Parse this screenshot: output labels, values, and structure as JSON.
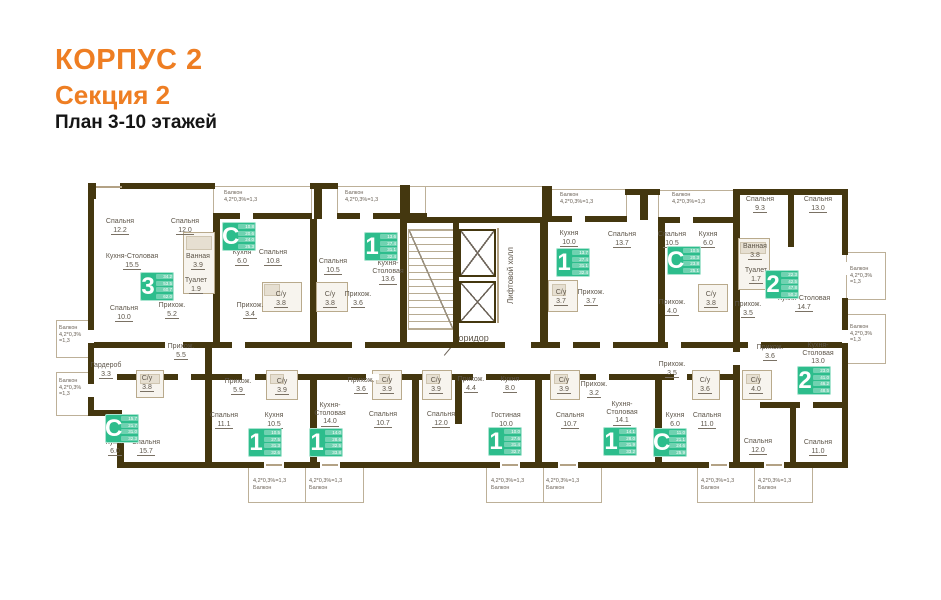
{
  "title": {
    "line1": "КОРПУС 2",
    "line2": "Секция 2",
    "line3": "План 3-10 этажей"
  },
  "zones": {
    "corridor": "Коридор",
    "lift_hall": "Лифтовой холл",
    "open_balcony": "Открытый балкон"
  },
  "colors": {
    "accent_orange": "#ee7e23",
    "wall_dark": "#44370f",
    "wall_thin": "#b3a285",
    "badge_green": "#2dbd8c",
    "label_gray": "#5e564a"
  },
  "plan": {
    "rooms": [
      {
        "n": "Спальня",
        "a": "12.2",
        "x": 120,
        "y": 226
      },
      {
        "n": "Спальня",
        "a": "12.0",
        "x": 185,
        "y": 226
      },
      {
        "n": "Кухня-Столовая",
        "a": "15.5",
        "x": 132,
        "y": 261
      },
      {
        "n": "Ванная",
        "a": "3.9",
        "x": 198,
        "y": 261
      },
      {
        "n": "Туалет",
        "a": "1.9",
        "x": 196,
        "y": 285
      },
      {
        "n": "Спальня",
        "a": "10.0",
        "x": 124,
        "y": 313
      },
      {
        "n": "Прихож.",
        "a": "5.2",
        "x": 172,
        "y": 310
      },
      {
        "n": "Кухня",
        "a": "6.0",
        "x": 242,
        "y": 257
      },
      {
        "n": "Спальня",
        "a": "10.8",
        "x": 273,
        "y": 257
      },
      {
        "n": "С/у",
        "a": "3.8",
        "x": 281,
        "y": 299
      },
      {
        "n": "Прихож.",
        "a": "3.4",
        "x": 250,
        "y": 310
      },
      {
        "n": "Спальня",
        "a": "10.5",
        "x": 333,
        "y": 266
      },
      {
        "n": "С/у",
        "a": "3.8",
        "x": 330,
        "y": 299
      },
      {
        "n": "Прихож.",
        "a": "3.6",
        "x": 358,
        "y": 299
      },
      {
        "n": "Кухня-\nСтоловая",
        "a": "13.6",
        "x": 388,
        "y": 271
      },
      {
        "n": "Кухня",
        "a": "10.0",
        "x": 569,
        "y": 238
      },
      {
        "n": "Спальня",
        "a": "13.7",
        "x": 622,
        "y": 239
      },
      {
        "n": "С/у",
        "a": "3.7",
        "x": 561,
        "y": 297
      },
      {
        "n": "Прихож.",
        "a": "3.7",
        "x": 591,
        "y": 297
      },
      {
        "n": "Спальня",
        "a": "10.5",
        "x": 672,
        "y": 239
      },
      {
        "n": "Кухня",
        "a": "6.0",
        "x": 708,
        "y": 239
      },
      {
        "n": "Прихож.",
        "a": "4.0",
        "x": 672,
        "y": 307
      },
      {
        "n": "С/у",
        "a": "3.8",
        "x": 711,
        "y": 299
      },
      {
        "n": "Спальня",
        "a": "9.3",
        "x": 760,
        "y": 204
      },
      {
        "n": "Спальня",
        "a": "13.0",
        "x": 818,
        "y": 204
      },
      {
        "n": "Ванная",
        "a": "3.8",
        "x": 755,
        "y": 251
      },
      {
        "n": "Туалет",
        "a": "1.7",
        "x": 756,
        "y": 275
      },
      {
        "n": "Кухня-Столовая",
        "a": "14.7",
        "x": 804,
        "y": 303
      },
      {
        "n": "Прихож.",
        "a": "3.5",
        "x": 748,
        "y": 309
      },
      {
        "n": "Гардероб",
        "a": "3.3",
        "x": 106,
        "y": 370
      },
      {
        "n": "Прихож.",
        "a": "5.5",
        "x": 181,
        "y": 351
      },
      {
        "n": "С/у",
        "a": "3.8",
        "x": 147,
        "y": 383
      },
      {
        "n": "Кухня",
        "a": "6.0",
        "x": 115,
        "y": 447
      },
      {
        "n": "Спальня",
        "a": "15.7",
        "x": 146,
        "y": 447
      },
      {
        "n": "Спальня",
        "a": "11.1",
        "x": 224,
        "y": 420
      },
      {
        "n": "Прихож.",
        "a": "5.9",
        "x": 238,
        "y": 386
      },
      {
        "n": "С/у",
        "a": "3.9",
        "x": 282,
        "y": 386
      },
      {
        "n": "Кухня",
        "a": "10.5",
        "x": 274,
        "y": 420
      },
      {
        "n": "Прихож.",
        "a": "3.6",
        "x": 361,
        "y": 385
      },
      {
        "n": "С/у",
        "a": "3.9",
        "x": 387,
        "y": 385
      },
      {
        "n": "Кухня-\nСтоловая",
        "a": "14.0",
        "x": 330,
        "y": 413
      },
      {
        "n": "Спальня",
        "a": "10.7",
        "x": 383,
        "y": 419
      },
      {
        "n": "С/у",
        "a": "3.9",
        "x": 436,
        "y": 385
      },
      {
        "n": "Прихож.",
        "a": "4.4",
        "x": 471,
        "y": 384
      },
      {
        "n": "Спальня",
        "a": "12.0",
        "x": 441,
        "y": 419
      },
      {
        "n": "Кухня",
        "a": "8.0",
        "x": 510,
        "y": 384
      },
      {
        "n": "Гостиная",
        "a": "10.0",
        "x": 506,
        "y": 420
      },
      {
        "n": "С/у",
        "a": "3.9",
        "x": 564,
        "y": 385
      },
      {
        "n": "Спальня",
        "a": "10.7",
        "x": 570,
        "y": 420
      },
      {
        "n": "Прихож.",
        "a": "3.2",
        "x": 594,
        "y": 389
      },
      {
        "n": "Кухня-\nСтоловая",
        "a": "14.1",
        "x": 622,
        "y": 412
      },
      {
        "n": "Прихож.",
        "a": "3.5",
        "x": 672,
        "y": 369
      },
      {
        "n": "С/у",
        "a": "3.6",
        "x": 705,
        "y": 385
      },
      {
        "n": "С/у",
        "a": "4.0",
        "x": 756,
        "y": 385
      },
      {
        "n": "Кухня",
        "a": "6.0",
        "x": 675,
        "y": 420
      },
      {
        "n": "Спальня",
        "a": "11.0",
        "x": 707,
        "y": 420
      },
      {
        "n": "Прихож.",
        "a": "3.6",
        "x": 770,
        "y": 352
      },
      {
        "n": "Кухня-\nСтоловая",
        "a": "13.0",
        "x": 818,
        "y": 353
      },
      {
        "n": "Спальня",
        "a": "12.0",
        "x": 758,
        "y": 446
      },
      {
        "n": "Спальня",
        "a": "11.0",
        "x": 818,
        "y": 447
      }
    ],
    "badges": [
      {
        "d": "3",
        "x": 140,
        "y": 272,
        "rows": [
          "34.2",
          "53.5",
          "60.7",
          "62.0"
        ]
      },
      {
        "d": "С",
        "x": 222,
        "y": 222,
        "rows": [
          "10.8",
          "20.6",
          "24.0",
          "25.3"
        ]
      },
      {
        "d": "1",
        "x": 364,
        "y": 232,
        "rows": [
          "13.6",
          "27.4",
          "31.1",
          "32.4"
        ]
      },
      {
        "d": "1",
        "x": 556,
        "y": 248,
        "rows": [
          "13.7",
          "27.4",
          "31.1",
          "32.4"
        ]
      },
      {
        "d": "С",
        "x": 667,
        "y": 246,
        "rows": [
          "10.5",
          "20.3",
          "23.8",
          "25.1"
        ]
      },
      {
        "d": "2",
        "x": 765,
        "y": 270,
        "rows": [
          "22.3",
          "42.5",
          "47.8",
          "50.2"
        ]
      },
      {
        "d": "С",
        "x": 105,
        "y": 414,
        "rows": [
          "15.7",
          "21.7",
          "31.0",
          "32.3"
        ]
      },
      {
        "d": "1",
        "x": 248,
        "y": 428,
        "rows": [
          "10.5",
          "27.5",
          "31.3",
          "32.6"
        ]
      },
      {
        "d": "1",
        "x": 309,
        "y": 428,
        "rows": [
          "14.0",
          "28.6",
          "32.5",
          "33.8"
        ]
      },
      {
        "d": "1",
        "x": 488,
        "y": 427,
        "rows": [
          "10.0",
          "27.6",
          "31.4",
          "32.7"
        ]
      },
      {
        "d": "1",
        "x": 603,
        "y": 427,
        "rows": [
          "14.1",
          "28.0",
          "31.9",
          "33.2"
        ]
      },
      {
        "d": "С",
        "x": 653,
        "y": 428,
        "rows": [
          "11.0",
          "21.1",
          "24.6",
          "25.9"
        ]
      },
      {
        "d": "2",
        "x": 797,
        "y": 366,
        "rows": [
          "23.0",
          "41.0",
          "46.2",
          "48.5"
        ]
      }
    ],
    "balconies": [
      {
        "b": [
          213,
          186,
          97,
          30
        ],
        "label": "Балкон\n4,2*0,3%=1,3",
        "tx": 224,
        "ty": 190
      },
      {
        "b": [
          337,
          186,
          88,
          30
        ],
        "label": "Балкон\n4,2*0,3%=1,3",
        "tx": 345,
        "ty": 190
      },
      {
        "b": [
          548,
          189,
          77,
          30
        ],
        "label": "Балкон\n4,2*0,3%=1,3",
        "tx": 560,
        "ty": 192
      },
      {
        "b": [
          658,
          190,
          75,
          30
        ],
        "label": "Балкон\n4,2*0,3%=1,3",
        "tx": 672,
        "ty": 192
      },
      {
        "b": [
          425,
          186,
          117,
          34
        ],
        "label": "",
        "tx": 0,
        "ty": 0
      },
      {
        "b": [
          846,
          252,
          38,
          46
        ],
        "label": "Балкон\n4,2*0,3%\n=1,3",
        "tx": 850,
        "ty": 266
      },
      {
        "b": [
          846,
          314,
          38,
          48
        ],
        "label": "Балкон\n4,2*0,3%\n=1,3",
        "tx": 850,
        "ty": 324
      },
      {
        "b": [
          56,
          320,
          32,
          36
        ],
        "label": "Балкон\n4,2*0,3%\n=1,3",
        "tx": 59,
        "ty": 325
      },
      {
        "b": [
          56,
          372,
          32,
          42
        ],
        "label": "Балкон\n4,2*0,3%\n=1,3",
        "tx": 59,
        "ty": 378
      },
      {
        "b": [
          248,
          465,
          57,
          36
        ],
        "label": "4,2*0,3%=1,3\nБалкон",
        "tx": 253,
        "ty": 478
      },
      {
        "b": [
          305,
          465,
          57,
          36
        ],
        "label": "4,2*0,3%=1,3\nБалкон",
        "tx": 309,
        "ty": 478
      },
      {
        "b": [
          486,
          465,
          57,
          36
        ],
        "label": "4,2*0,3%=1,3\nБалкон",
        "tx": 491,
        "ty": 478
      },
      {
        "b": [
          543,
          465,
          57,
          36
        ],
        "label": "4,2*0,3%=1,3\nБалкон",
        "tx": 546,
        "ty": 478
      },
      {
        "b": [
          697,
          465,
          57,
          36
        ],
        "label": "4,2*0,3%=1,3\nБалкон",
        "tx": 701,
        "ty": 478
      },
      {
        "b": [
          754,
          465,
          57,
          36
        ],
        "label": "4,2*0,3%=1,3\nБалкон",
        "tx": 758,
        "ty": 478
      }
    ],
    "walls_thick": [
      [
        88,
        195,
        6,
        219
      ],
      [
        88,
        410,
        34,
        6
      ],
      [
        117,
        416,
        7,
        52
      ],
      [
        117,
        462,
        731,
        6
      ],
      [
        120,
        183,
        95,
        6
      ],
      [
        310,
        183,
        28,
        6
      ],
      [
        314,
        186,
        8,
        33
      ],
      [
        213,
        213,
        99,
        6
      ],
      [
        337,
        213,
        90,
        6
      ],
      [
        400,
        185,
        10,
        32
      ],
      [
        542,
        186,
        10,
        33
      ],
      [
        625,
        189,
        35,
        6
      ],
      [
        640,
        192,
        8,
        28
      ],
      [
        548,
        216,
        79,
        6
      ],
      [
        658,
        217,
        77,
        6
      ],
      [
        733,
        189,
        115,
        6
      ],
      [
        842,
        189,
        6,
        66
      ],
      [
        842,
        298,
        6,
        18
      ],
      [
        842,
        316,
        6,
        46
      ],
      [
        842,
        362,
        6,
        106
      ],
      [
        213,
        219,
        7,
        129
      ],
      [
        310,
        219,
        7,
        129
      ],
      [
        400,
        217,
        7,
        131
      ],
      [
        540,
        217,
        8,
        131
      ],
      [
        658,
        223,
        7,
        125
      ],
      [
        733,
        189,
        7,
        159
      ],
      [
        788,
        189,
        6,
        58
      ],
      [
        400,
        217,
        148,
        6
      ],
      [
        453,
        223,
        6,
        119
      ],
      [
        88,
        342,
        754,
        6
      ],
      [
        117,
        374,
        616,
        6
      ],
      [
        733,
        342,
        7,
        126
      ],
      [
        205,
        348,
        7,
        120
      ],
      [
        310,
        374,
        7,
        94
      ],
      [
        412,
        374,
        7,
        94
      ],
      [
        455,
        374,
        7,
        50
      ],
      [
        535,
        374,
        7,
        94
      ],
      [
        655,
        374,
        7,
        94
      ],
      [
        760,
        402,
        82,
        6
      ],
      [
        790,
        406,
        6,
        58
      ],
      [
        88,
        183,
        8,
        16
      ]
    ],
    "walls_thin": [
      [
        497,
        228,
        2,
        95
      ]
    ],
    "gaps": [
      [
        232,
        342,
        13,
        6
      ],
      [
        352,
        342,
        13,
        6
      ],
      [
        560,
        342,
        13,
        6
      ],
      [
        600,
        342,
        13,
        6
      ],
      [
        668,
        342,
        13,
        6
      ],
      [
        748,
        342,
        13,
        6
      ],
      [
        178,
        374,
        13,
        6
      ],
      [
        242,
        374,
        13,
        6
      ],
      [
        366,
        374,
        13,
        6
      ],
      [
        473,
        374,
        13,
        6
      ],
      [
        596,
        374,
        13,
        6
      ],
      [
        674,
        374,
        13,
        6
      ],
      [
        264,
        462,
        20,
        6
      ],
      [
        320,
        462,
        20,
        6
      ],
      [
        500,
        462,
        20,
        6
      ],
      [
        558,
        462,
        20,
        6
      ],
      [
        709,
        462,
        20,
        6
      ],
      [
        764,
        462,
        20,
        6
      ],
      [
        240,
        213,
        13,
        6
      ],
      [
        360,
        213,
        13,
        6
      ],
      [
        572,
        216,
        13,
        6
      ],
      [
        680,
        217,
        13,
        6
      ],
      [
        842,
        262,
        6,
        13
      ],
      [
        842,
        330,
        6,
        13
      ],
      [
        88,
        330,
        6,
        13
      ],
      [
        88,
        384,
        6,
        13
      ],
      [
        733,
        352,
        7,
        13
      ],
      [
        800,
        402,
        13,
        6
      ],
      [
        505,
        342,
        26,
        6
      ],
      [
        165,
        342,
        18,
        6
      ]
    ],
    "windows": [
      [
        96,
        186,
        26
      ],
      [
        266,
        464,
        16
      ],
      [
        322,
        464,
        16
      ],
      [
        502,
        464,
        16
      ],
      [
        560,
        464,
        16
      ],
      [
        711,
        464,
        16
      ],
      [
        766,
        464,
        16
      ]
    ],
    "partitions": [
      [
        183,
        232,
        30,
        60
      ],
      [
        262,
        282,
        38,
        28
      ],
      [
        316,
        282,
        30,
        28
      ],
      [
        548,
        280,
        28,
        30
      ],
      [
        698,
        284,
        28,
        26
      ],
      [
        738,
        238,
        30,
        50
      ],
      [
        136,
        370,
        26,
        26
      ],
      [
        266,
        370,
        30,
        28
      ],
      [
        372,
        370,
        28,
        28
      ],
      [
        422,
        370,
        28,
        28
      ],
      [
        550,
        370,
        28,
        28
      ],
      [
        692,
        370,
        26,
        28
      ],
      [
        742,
        370,
        28,
        28
      ]
    ],
    "furniture": [
      [
        186,
        236,
        24,
        12
      ],
      [
        264,
        284,
        14,
        10
      ],
      [
        552,
        284,
        12,
        10
      ],
      [
        740,
        242,
        24,
        10
      ],
      [
        140,
        374,
        18,
        8
      ],
      [
        270,
        374,
        12,
        8
      ],
      [
        376,
        374,
        12,
        8
      ],
      [
        426,
        374,
        12,
        8
      ],
      [
        554,
        374,
        12,
        8
      ],
      [
        746,
        374,
        12,
        8
      ]
    ]
  }
}
